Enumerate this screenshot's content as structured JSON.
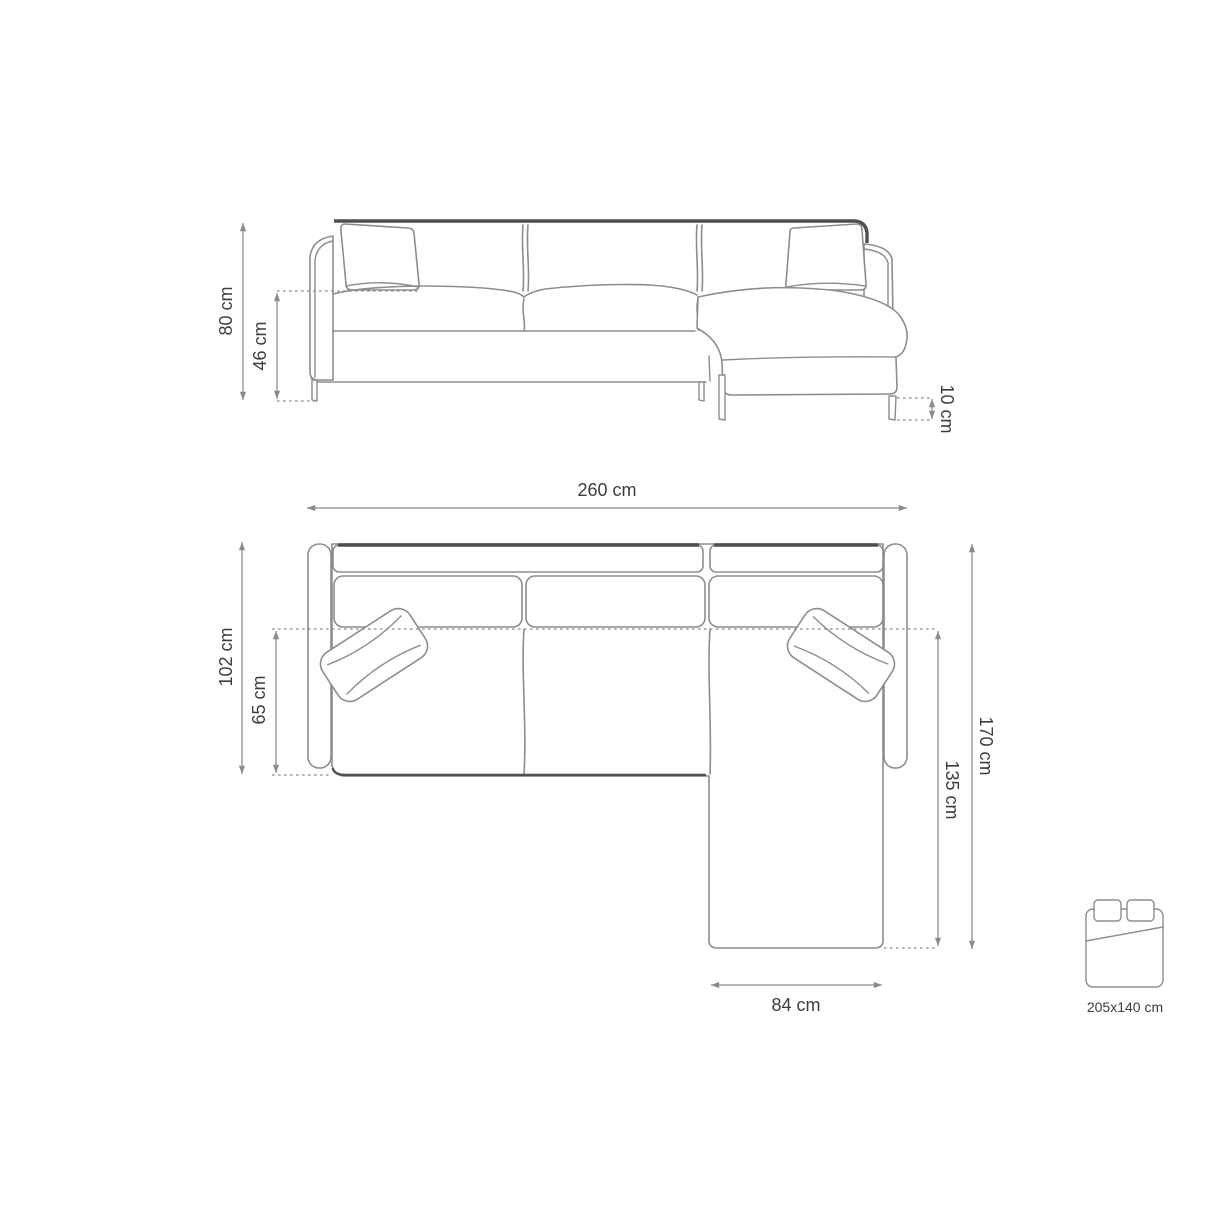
{
  "colors": {
    "paper": "#ffffff",
    "outline": "#8d8d8d",
    "accent": "#4f4f4f",
    "dim": "#8b8b8b",
    "ink": "#3d3d3d"
  },
  "front_view": {
    "dims": {
      "overall_height": "80 cm",
      "seat_height": "46 cm",
      "leg_height": "10 cm"
    }
  },
  "top_view": {
    "dims": {
      "overall_width": "260 cm",
      "overall_depth": "102 cm",
      "seat_depth": "65 cm",
      "overall_length": "170 cm",
      "chaise_length": "135 cm",
      "chaise_width": "84 cm"
    }
  },
  "sleeping_area": {
    "icon": "double-bed-icon",
    "label": "205x140 cm"
  }
}
